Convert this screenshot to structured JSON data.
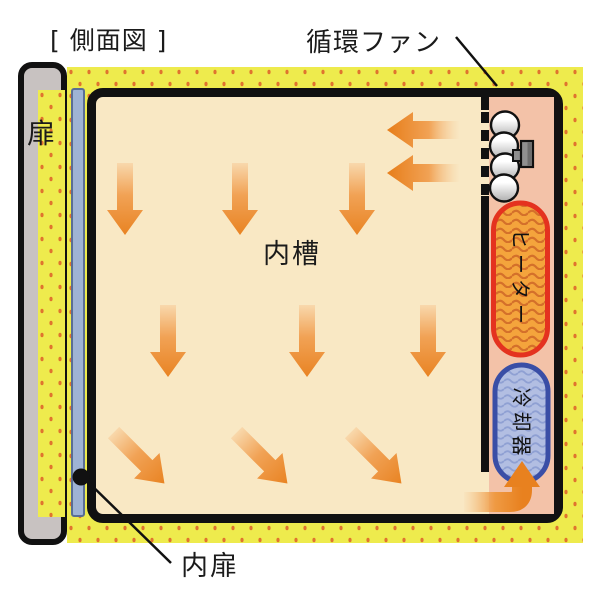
{
  "title": "[ 側面図 ]",
  "labels": {
    "door": "扉",
    "fan": "循環ファン",
    "chamber": "内槽",
    "inner_door": "内扉",
    "heater": "ヒーター",
    "cooler": "冷却器"
  },
  "icons": {
    "fan": "circulation-fan-icon",
    "heater": "heater-coil-icon",
    "cooler": "cooler-coil-icon",
    "airflow_down": "down-airflow-arrow-icon",
    "airflow_left": "left-airflow-arrow-icon",
    "airflow_diagonal": "diagonal-airflow-arrow-icon",
    "airflow_return": "return-airflow-arrow-icon"
  },
  "colors": {
    "insulation_yellow": "#eeeb4d",
    "insulation_dot_orange": "#e0742e",
    "chamber_cream": "#f9e8c4",
    "compartment_salmon": "#f3c2a8",
    "arrow_orange": "#e8811f",
    "arrow_light": "#f8d6a8",
    "heater_fill": "#f4a43c",
    "heater_border": "#e4321f",
    "heater_wave": "#d4702a",
    "cooler_fill": "#b2bee2",
    "cooler_border": "#3a4ea6",
    "cooler_wave": "#8fa0d3",
    "door_gray": "#c8c2c1",
    "inner_door_blue": "#9fb3d4",
    "inner_door_border": "#5a6e94",
    "outline_black": "#111111"
  }
}
